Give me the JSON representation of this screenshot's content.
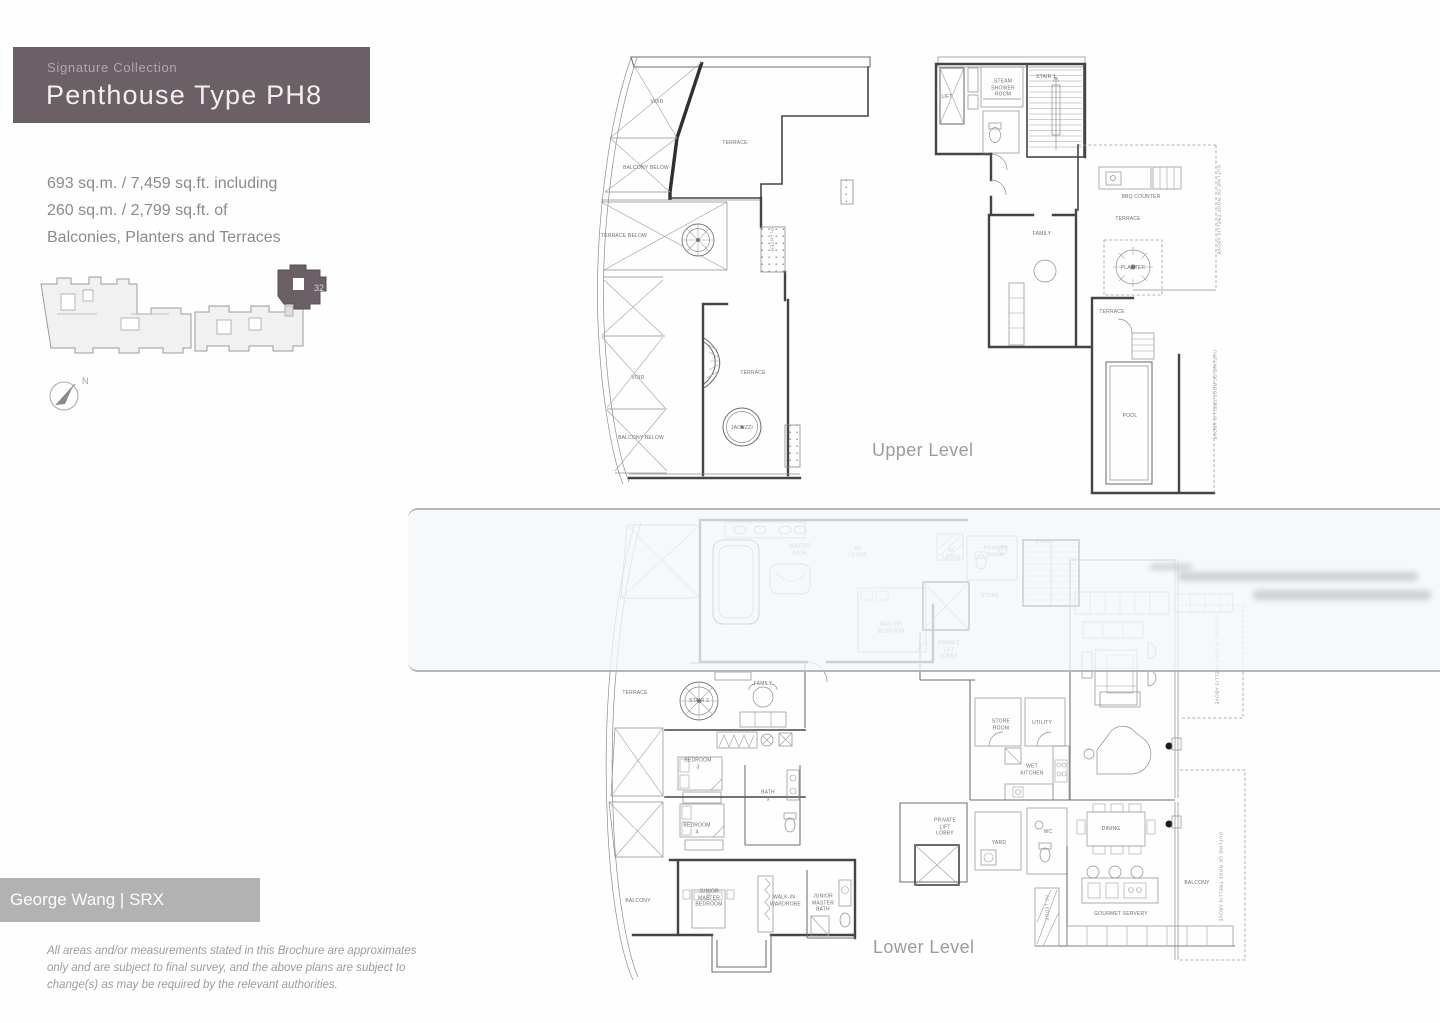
{
  "header": {
    "collection_label": "Signature Collection",
    "title": "Penthouse Type PH8"
  },
  "area_summary": {
    "lines": [
      "693 sq.m. / 7,459 sq.ft. including",
      "260 sq.m. / 2,799 sq.ft. of",
      "Balconies, Planters and Terraces"
    ]
  },
  "key_plan": {
    "highlighted_unit": "32",
    "north_label": "N"
  },
  "upper_level": {
    "caption": "Upper Level",
    "left_wing_labels": [
      "VOID",
      "TERRACE",
      "BALCONY BELOW",
      "TERRACE BELOW",
      "PLANTER",
      "VOID",
      "TERRACE",
      "JACUZZI",
      "BALCONY BELOW"
    ],
    "right_wing_labels": [
      "LIFT",
      "STEAM SHOWER ROOM",
      "STAIR 1",
      "FAMILY",
      "BBQ COUNTER",
      "TERRACE",
      "PLANTER",
      "TERRACE",
      "POOL"
    ],
    "right_wing_notes": [
      "OUTLINE OF ROOF TRELLIS ABOVE",
      "OUTLINE OF ROOF TRELLIS ABOVE"
    ]
  },
  "lower_level": {
    "caption": "Lower Level",
    "labels": [
      "MASTER BATH",
      "AC LEDGE",
      "MASTER BEDROOM",
      "AC LEDGE",
      "POWDER ROOM",
      "STAIR 1",
      "STORE",
      "PRIVATE LIFT LOBBY",
      "FAMILY",
      "TERRACE",
      "STAIR 2",
      "BEDROOM 3",
      "BEDROOM 4",
      "BATH 3",
      "BALCONY",
      "JUNIOR MASTER BEDROOM",
      "WALK-IN WARDROBE",
      "JUNIOR MASTER BATH",
      "STORE ROOM",
      "UTILITY",
      "WET KITCHEN",
      "YARD",
      "WC",
      "DINING",
      "GOURMET SERVERY",
      "AC LEDGE",
      "BALCONY",
      "PRIVATE LIFT LOBBY"
    ],
    "notes": [
      "OUTLINE OF ROOF TRELLIS ABOVE",
      "OUTLINE OF ROOF TRELLIS ABOVE"
    ]
  },
  "watermark": {
    "agent_label": "George Wang | SRX PROPERTY"
  },
  "disclaimer": {
    "lines": [
      "All areas and/or measurements stated in this Brochure are approximates",
      "only and are subject to final survey, and the above plans are subject to",
      "change(s) as may be required by the relevant authorities."
    ]
  },
  "colors": {
    "header_bg": "#6b6066",
    "unit_highlight": "#6b6066",
    "watermark_badge_bg": "#b2b2b2",
    "band_border": "#b4b8bb",
    "body_text_gray": "#8b8b8b"
  }
}
